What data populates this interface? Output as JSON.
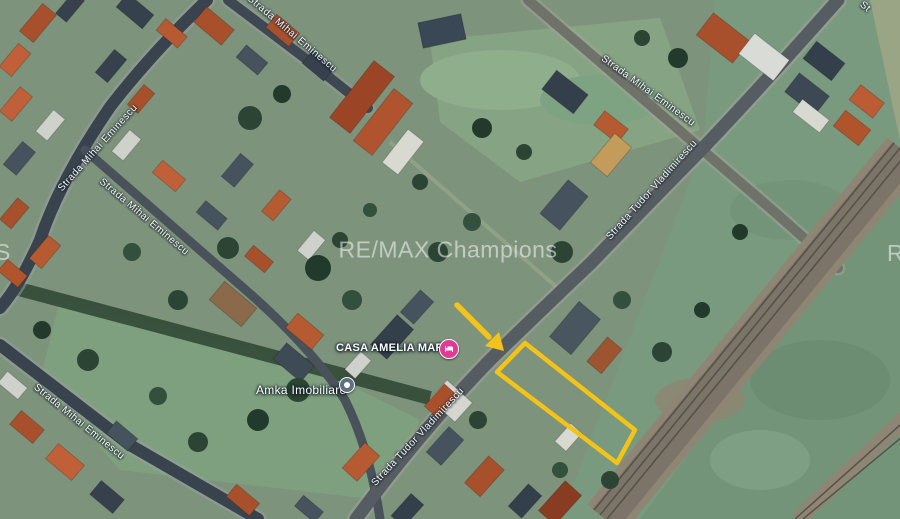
{
  "map": {
    "view_type": "satellite",
    "watermark": {
      "text": "RE/MAX Champions",
      "left_fragment": "S",
      "right_fragment": "R"
    },
    "street_labels": [
      {
        "text": "Strada Mihai Eminescu"
      },
      {
        "text": "Strada Mihai Eminescu"
      },
      {
        "text": "Strada Mihai Eminescu"
      },
      {
        "text": "Strada Mihai Eminescu"
      },
      {
        "text": "Strada Mihai Eminescu"
      },
      {
        "text": "Strada Tudor Vladimirescu"
      },
      {
        "text": "Strada Tudor Vladimirescu"
      },
      {
        "text": "St"
      }
    ],
    "pois": [
      {
        "label": "CASA AMELIA MARIA",
        "marker": "lodging",
        "marker_color": "#e03a94"
      },
      {
        "label": "Amka Imobiliare",
        "marker": "generic",
        "marker_color": "#5f7180"
      }
    ],
    "highlight": {
      "color": "#F3C31A",
      "parcel_points": "525,343 635,430 617,463 497,372",
      "arrow_line": "M457 305 L489 337",
      "arrow_head_points": "504,351 485,346 499,332"
    },
    "colors": {
      "field_green": "#7a9a80",
      "road_dark": "#39434e",
      "railway": "#8e8574",
      "roof_orange": "#b0542c",
      "roof_dark": "#333f4b",
      "label_text": "#ffffff"
    }
  }
}
